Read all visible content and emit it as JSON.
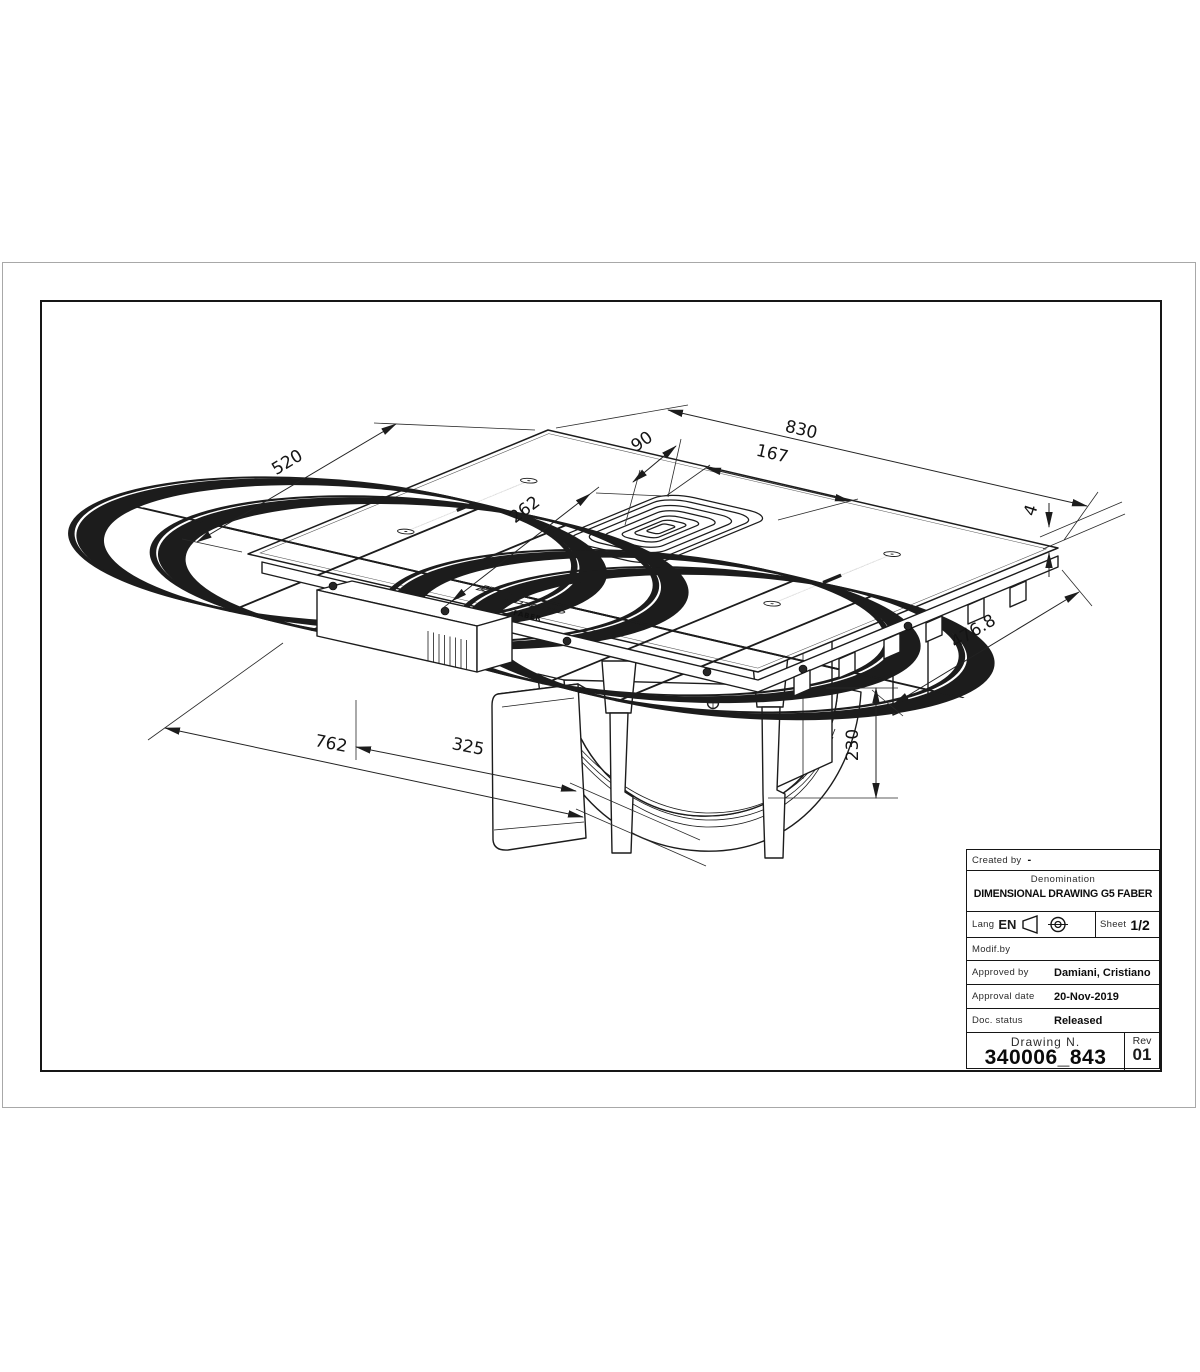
{
  "page": {
    "background": "#ffffff"
  },
  "frame": {
    "outer_border_color": "#a8a8a8",
    "inner_border_color": "#161616"
  },
  "drawing": {
    "brand": "FABER",
    "dims": {
      "d520": "520",
      "d830": "830",
      "d90": "90",
      "d167": "167",
      "d262": "262",
      "d4": "4",
      "d476_8": "476.8",
      "d230": "230",
      "d762": "762",
      "d325": "325"
    }
  },
  "title_block": {
    "created_by_label": "Created by",
    "created_by_value": "-",
    "denomination_label": "Denomination",
    "denomination_value": "DIMENSIONAL DRAWING G5 FABER",
    "lang_label": "Lang",
    "lang_value": "EN",
    "sheet_label": "Sheet",
    "sheet_value": "1/2",
    "modif_label": "Modif.by",
    "approved_label": "Approved by",
    "approved_value": "Damiani, Cristiano",
    "approval_date_label": "Approval date",
    "approval_date_value": "20-Nov-2019",
    "doc_status_label": "Doc. status",
    "doc_status_value": "Released",
    "drawing_n_label": "Drawing N.",
    "drawing_n_value": "340006_843",
    "rev_label": "Rev",
    "rev_value": "01"
  }
}
